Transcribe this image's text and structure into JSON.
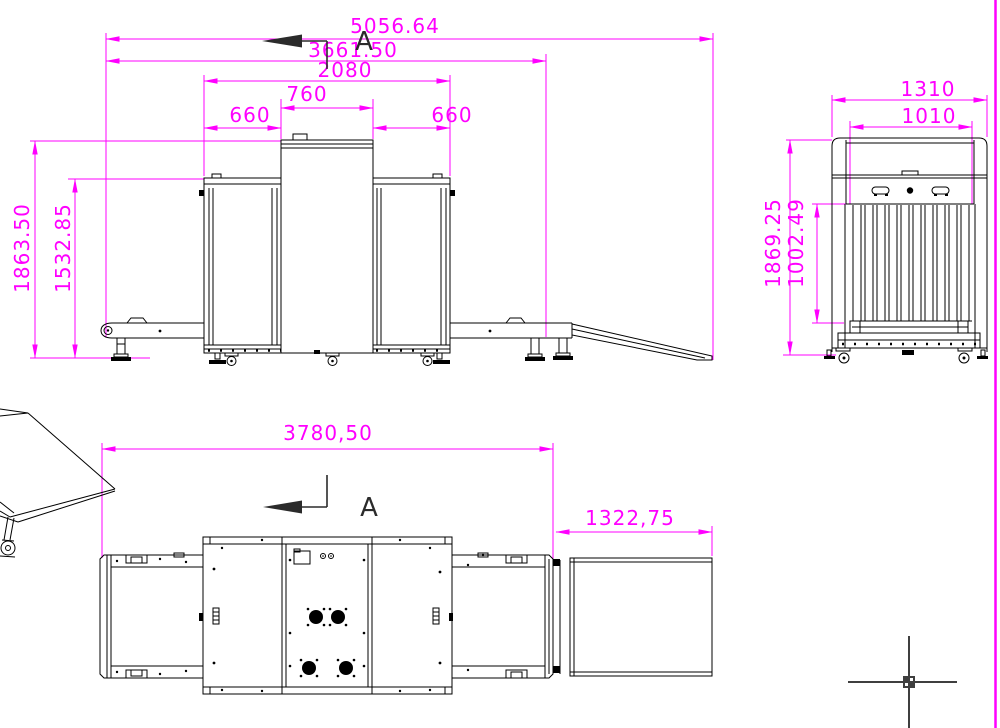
{
  "colors": {
    "dim": "#ff00ff",
    "line": "#000000",
    "sec": "#2b2b2b",
    "mark": "#3f3f3f",
    "bg": "#ffffff"
  },
  "front_view": {
    "dims": {
      "overall_length": "5056.64",
      "conveyor_length": "3661.50",
      "cabinet_length": "2080",
      "tunnel_width": "760",
      "left_section": "660",
      "right_section": "660",
      "overall_height": "1863.50",
      "cabinet_height": "1532.85"
    },
    "section_label": "A"
  },
  "end_view": {
    "dims": {
      "overall_width": "1310",
      "tunnel_width": "1010",
      "overall_height": "1869.25",
      "belt_height": "1002.49"
    }
  },
  "plan_view": {
    "dims": {
      "body_length": "3780,50",
      "ramp_length": "1322,75"
    },
    "section_label": "A"
  }
}
